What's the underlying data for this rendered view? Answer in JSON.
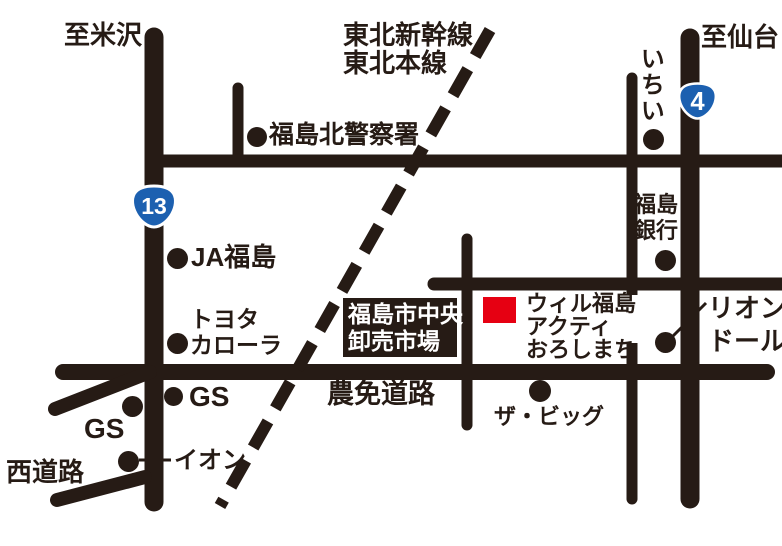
{
  "map": {
    "title_hint": "access-map",
    "background_color": "#ffffff",
    "road_color": "#261b15",
    "destination_marker_color": "#e60012",
    "route_badge_color": "#1c60b0",
    "directions": {
      "to_yonezawa": "至米沢",
      "to_sendai": "至仙台"
    },
    "railway": {
      "line1": "東北新幹線",
      "line2": "東北本線"
    },
    "route_badges": [
      {
        "number": "13"
      },
      {
        "number": "4"
      }
    ],
    "roads": {
      "nomen": "農免道路",
      "nishi": "西道路"
    },
    "landmarks": {
      "police": "福島北警察署",
      "ichii": "いちい",
      "ja": "JA福島",
      "bank_line1": "福島",
      "bank_line2": "銀行",
      "toyota_line1": "トヨタ",
      "toyota_line2": "カローラ",
      "market_line1": "福島市中央",
      "market_line2": "卸売市場",
      "wil_line1": "ウィル福島",
      "wil_line2": "アクティ",
      "wil_line3": "おろしまち",
      "lion_line1": "リオン",
      "lion_line2": "ドール",
      "big": "ザ・ビッグ",
      "gs_left": "GS",
      "gs_right": "GS",
      "aeon": "イオン"
    }
  }
}
